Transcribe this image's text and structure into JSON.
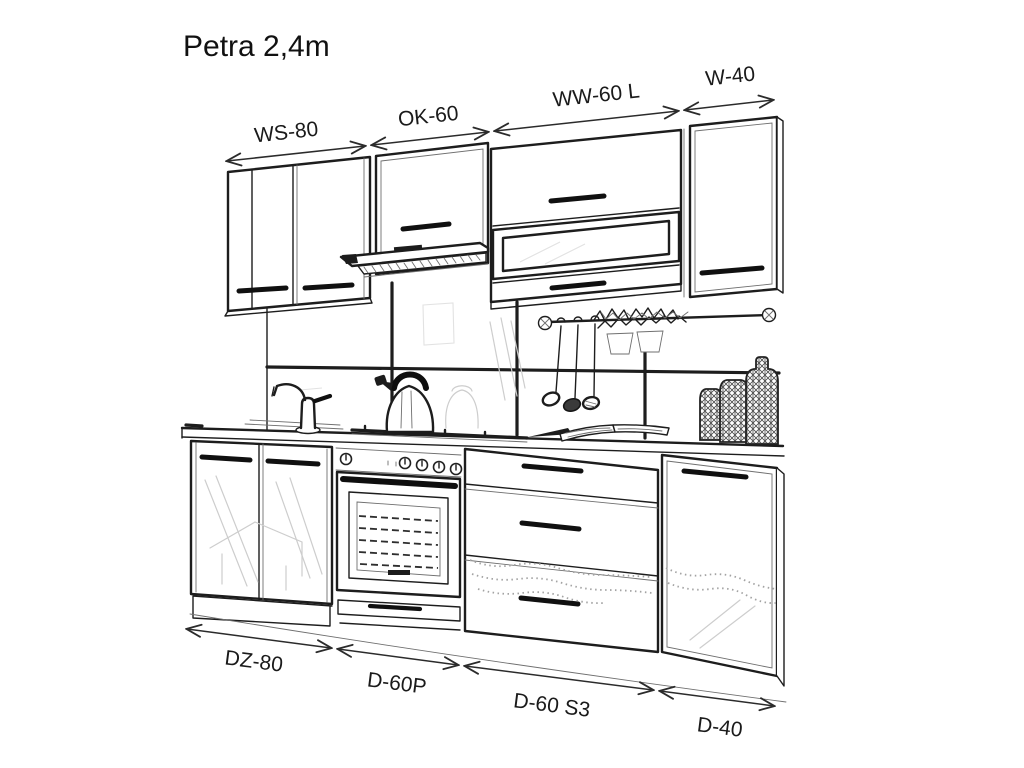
{
  "title": "Petra 2,4m",
  "diagram": {
    "description": "kitchen-set-line-drawing",
    "top_dimensions": [
      {
        "label": "WS-80"
      },
      {
        "label": "OK-60"
      },
      {
        "label": "WW-60 L"
      },
      {
        "label": "W-40"
      }
    ],
    "bottom_dimensions": [
      {
        "label": "DZ-80"
      },
      {
        "label": "D-60P"
      },
      {
        "label": "D-60 S3"
      },
      {
        "label": "D-40"
      }
    ],
    "colors": {
      "line": "#1d1d1d",
      "background": "#ffffff",
      "faint_sketch": "#cdcdcd"
    }
  }
}
